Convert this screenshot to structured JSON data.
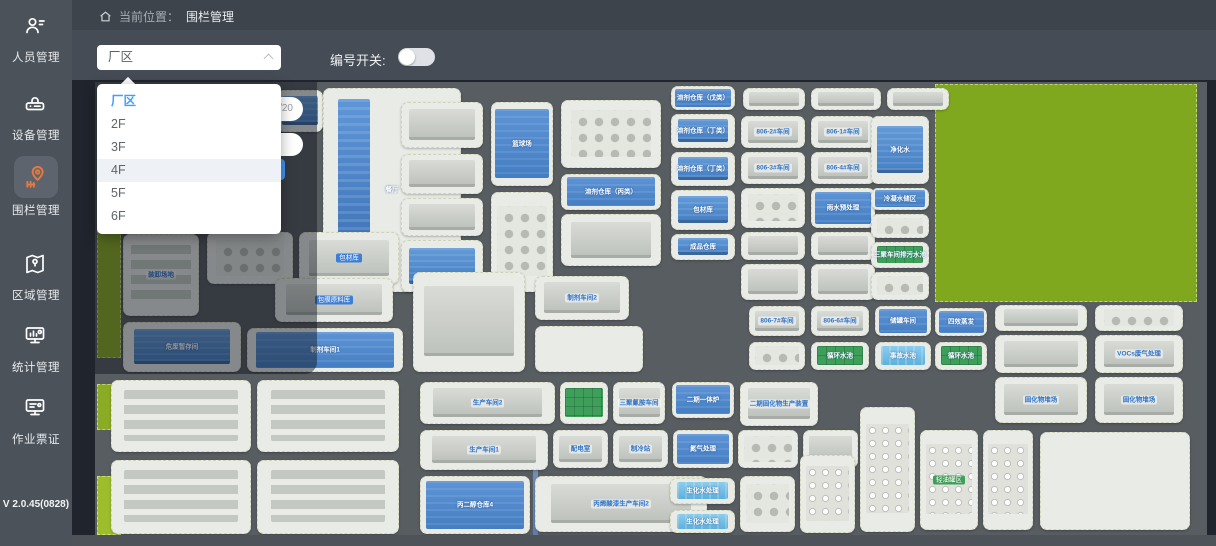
{
  "colors": {
    "accent": "#409eff",
    "active_icon": "#e8783c",
    "sidebar_bg": "#4b525a",
    "map_road": "#585d61",
    "grass": "#7fa81e"
  },
  "sidebar": {
    "version": "V 2.0.45(0828)",
    "items": [
      {
        "label": "人员管理",
        "icon": "person-icon",
        "active": false,
        "top": 14
      },
      {
        "label": "设备管理",
        "icon": "device-icon",
        "active": false,
        "top": 92
      },
      {
        "label": "围栏管理",
        "icon": "fence-pin-icon",
        "active": true,
        "top": 156
      },
      {
        "label": "区域管理",
        "icon": "map-area-icon",
        "active": false,
        "top": 252
      },
      {
        "label": "统计管理",
        "icon": "stats-monitor-icon",
        "active": false,
        "top": 324
      },
      {
        "label": "作业票证",
        "icon": "permit-monitor-icon",
        "active": false,
        "top": 396
      }
    ]
  },
  "header": {
    "breadcrumb_prefix": "当前位置：",
    "breadcrumb_current": "围栏管理"
  },
  "toolbar": {
    "floor_select_value": "厂区",
    "number_switch_label": "编号开关:",
    "switch_on": false
  },
  "dropdown": {
    "options": [
      {
        "label": "厂区",
        "selected": true,
        "hover": false
      },
      {
        "label": "2F",
        "selected": false,
        "hover": false
      },
      {
        "label": "3F",
        "selected": false,
        "hover": false
      },
      {
        "label": "4F",
        "selected": false,
        "hover": true
      },
      {
        "label": "5F",
        "selected": false,
        "hover": false
      },
      {
        "label": "6F",
        "selected": false,
        "hover": false
      }
    ]
  },
  "panel": {
    "counter": "0/20",
    "fragment": ")"
  },
  "map": {
    "greens": [
      [
        2,
        148,
        24,
        128,
        "#8cab24"
      ],
      [
        2,
        302,
        24,
        46,
        "#8cab24"
      ],
      [
        2,
        394,
        24,
        59,
        "#9dbd2c"
      ],
      [
        840,
        2,
        262,
        218,
        "#7fa81e"
      ]
    ],
    "road_stripe": [
      438,
      358,
      5,
      95
    ],
    "plots": [
      [
        14,
        10,
        150,
        62,
        "bars",
        "",
        ""
      ],
      [
        14,
        80,
        122,
        56,
        "gray",
        "",
        ""
      ],
      [
        182,
        8,
        46,
        42,
        "blue",
        "",
        ""
      ],
      [
        228,
        6,
        138,
        204,
        "tower",
        "餐厅",
        "lw"
      ],
      [
        306,
        20,
        82,
        46,
        "gray",
        "",
        ""
      ],
      [
        306,
        72,
        82,
        40,
        "gray",
        "",
        ""
      ],
      [
        306,
        116,
        82,
        38,
        "gray",
        "",
        ""
      ],
      [
        306,
        158,
        82,
        52,
        "blue",
        "",
        ""
      ],
      [
        396,
        20,
        62,
        84,
        "court",
        "篮球场",
        "lw"
      ],
      [
        396,
        110,
        62,
        100,
        "tanks",
        "",
        ""
      ],
      [
        466,
        18,
        100,
        68,
        "tanks",
        "",
        ""
      ],
      [
        466,
        92,
        100,
        36,
        "court",
        "溶剂仓库（丙类）",
        "lw"
      ],
      [
        466,
        132,
        100,
        52,
        "gray",
        "",
        ""
      ],
      [
        576,
        4,
        64,
        24,
        "court",
        "溶剂仓库（戊类）",
        "lw"
      ],
      [
        576,
        32,
        64,
        34,
        "blue",
        "溶剂仓库（丁类）",
        "lw"
      ],
      [
        576,
        70,
        64,
        34,
        "blue",
        "溶剂仓库（丁类）",
        "lw"
      ],
      [
        576,
        108,
        64,
        40,
        "blue",
        "包材库",
        "lw"
      ],
      [
        576,
        152,
        64,
        26,
        "blue",
        "成品仓库",
        "lw"
      ],
      [
        648,
        6,
        62,
        22,
        "gray",
        "",
        ""
      ],
      [
        716,
        6,
        70,
        22,
        "gray",
        "",
        ""
      ],
      [
        792,
        6,
        62,
        22,
        "gray",
        "",
        ""
      ],
      [
        646,
        34,
        64,
        32,
        "gray",
        "806-2#车间",
        "lt"
      ],
      [
        716,
        34,
        64,
        32,
        "gray",
        "806-1#车间",
        "lt"
      ],
      [
        646,
        70,
        64,
        32,
        "gray",
        "806-3#车间",
        "lt"
      ],
      [
        716,
        70,
        64,
        32,
        "gray",
        "806-4#车间",
        "lt"
      ],
      [
        646,
        106,
        64,
        40,
        "tanks",
        "",
        ""
      ],
      [
        716,
        106,
        64,
        40,
        "court",
        "雨水预处理",
        "lw"
      ],
      [
        646,
        150,
        64,
        28,
        "gray",
        "",
        ""
      ],
      [
        716,
        150,
        64,
        28,
        "gray",
        "",
        ""
      ],
      [
        776,
        34,
        58,
        68,
        "blue",
        "净化水",
        "lw"
      ],
      [
        776,
        106,
        58,
        22,
        "court",
        "冷凝水储区",
        "lw"
      ],
      [
        776,
        132,
        58,
        24,
        "tanks",
        "",
        ""
      ],
      [
        776,
        160,
        58,
        26,
        "pool",
        "三聚车间排污水池",
        "lw"
      ],
      [
        28,
        152,
        76,
        82,
        "bars",
        "装卸场地",
        "lt"
      ],
      [
        112,
        150,
        86,
        52,
        "tanks",
        "",
        ""
      ],
      [
        204,
        150,
        100,
        52,
        "gray",
        "包材库",
        "lc"
      ],
      [
        28,
        240,
        118,
        50,
        "blue",
        "危废暂存间",
        "lw"
      ],
      [
        152,
        246,
        156,
        44,
        "court",
        "制剂车间1",
        "lw"
      ],
      [
        180,
        196,
        118,
        44,
        "gray",
        "包膜原料库",
        "lc"
      ],
      [
        318,
        190,
        112,
        100,
        "gray",
        "",
        ""
      ],
      [
        440,
        194,
        94,
        44,
        "gray",
        "制剂车间2",
        "lt"
      ],
      [
        440,
        244,
        108,
        46,
        "plain",
        "",
        ""
      ],
      [
        646,
        182,
        64,
        36,
        "gray",
        "",
        ""
      ],
      [
        716,
        182,
        64,
        36,
        "gray",
        "",
        ""
      ],
      [
        776,
        190,
        58,
        28,
        "tanks",
        "",
        ""
      ],
      [
        654,
        224,
        56,
        30,
        "gray",
        "806-7#车间",
        "lt"
      ],
      [
        716,
        224,
        58,
        30,
        "gray",
        "806-6#车间",
        "lt"
      ],
      [
        780,
        224,
        56,
        30,
        "court",
        "储罐车间",
        "lw"
      ],
      [
        840,
        226,
        52,
        28,
        "court",
        "四效蒸发",
        "lw"
      ],
      [
        654,
        260,
        56,
        28,
        "tanks",
        "",
        ""
      ],
      [
        716,
        260,
        58,
        28,
        "pool",
        "循环水池",
        "lw"
      ],
      [
        780,
        260,
        56,
        28,
        "water",
        "事故水池",
        "lw"
      ],
      [
        840,
        260,
        52,
        28,
        "pool",
        "循环水池",
        "lw"
      ],
      [
        900,
        223,
        92,
        26,
        "gray",
        "",
        ""
      ],
      [
        1000,
        223,
        88,
        26,
        "tanks",
        "",
        ""
      ],
      [
        900,
        253,
        92,
        38,
        "gray",
        "",
        ""
      ],
      [
        1000,
        253,
        88,
        38,
        "gray",
        "VOCs废气处理",
        "lt"
      ],
      [
        900,
        295,
        92,
        46,
        "gray",
        "固化物堆场",
        "lt"
      ],
      [
        1000,
        295,
        88,
        46,
        "gray",
        "固化物堆场",
        "lt"
      ],
      [
        16,
        298,
        140,
        72,
        "bars",
        "",
        ""
      ],
      [
        162,
        298,
        142,
        72,
        "bars",
        "",
        ""
      ],
      [
        16,
        378,
        140,
        74,
        "bars",
        "",
        ""
      ],
      [
        162,
        378,
        142,
        74,
        "bars",
        "",
        ""
      ],
      [
        325,
        300,
        135,
        42,
        "gray",
        "生产车间2",
        "lt"
      ],
      [
        465,
        300,
        48,
        42,
        "pool",
        "",
        ""
      ],
      [
        518,
        300,
        52,
        42,
        "gray",
        "三聚氰胺车间",
        "lt"
      ],
      [
        577,
        300,
        62,
        36,
        "court",
        "二期一体炉",
        "lw"
      ],
      [
        645,
        300,
        78,
        44,
        "gray",
        "二期固化物生产装置",
        "lt"
      ],
      [
        325,
        348,
        128,
        40,
        "gray",
        "生产车间1",
        "lt"
      ],
      [
        458,
        348,
        55,
        38,
        "gray",
        "配电室",
        "lt"
      ],
      [
        518,
        348,
        55,
        38,
        "gray",
        "制冷站",
        "lt"
      ],
      [
        578,
        348,
        60,
        38,
        "court",
        "氮气处理",
        "lw"
      ],
      [
        643,
        348,
        60,
        38,
        "tanks",
        "",
        ""
      ],
      [
        708,
        348,
        55,
        38,
        "gray",
        "",
        ""
      ],
      [
        325,
        394,
        110,
        58,
        "court",
        "丙二醇仓库4",
        "lw"
      ],
      [
        440,
        394,
        172,
        56,
        "gray",
        "丙烯酸漆生产车间2",
        "lt"
      ],
      [
        645,
        394,
        55,
        56,
        "tanks",
        "",
        ""
      ],
      [
        575,
        396,
        65,
        26,
        "water",
        "生化水处理",
        "lw"
      ],
      [
        575,
        428,
        65,
        23,
        "water",
        "生化水处理",
        "lw"
      ],
      [
        705,
        373,
        55,
        78,
        "tankstall",
        "",
        ""
      ],
      [
        765,
        325,
        55,
        125,
        "tankstall",
        "",
        ""
      ],
      [
        825,
        348,
        58,
        100,
        "tankstall",
        "轻油罐区",
        "lg"
      ],
      [
        888,
        348,
        50,
        100,
        "tankstall",
        "",
        ""
      ],
      [
        945,
        350,
        150,
        98,
        "plain",
        "",
        ""
      ]
    ]
  }
}
